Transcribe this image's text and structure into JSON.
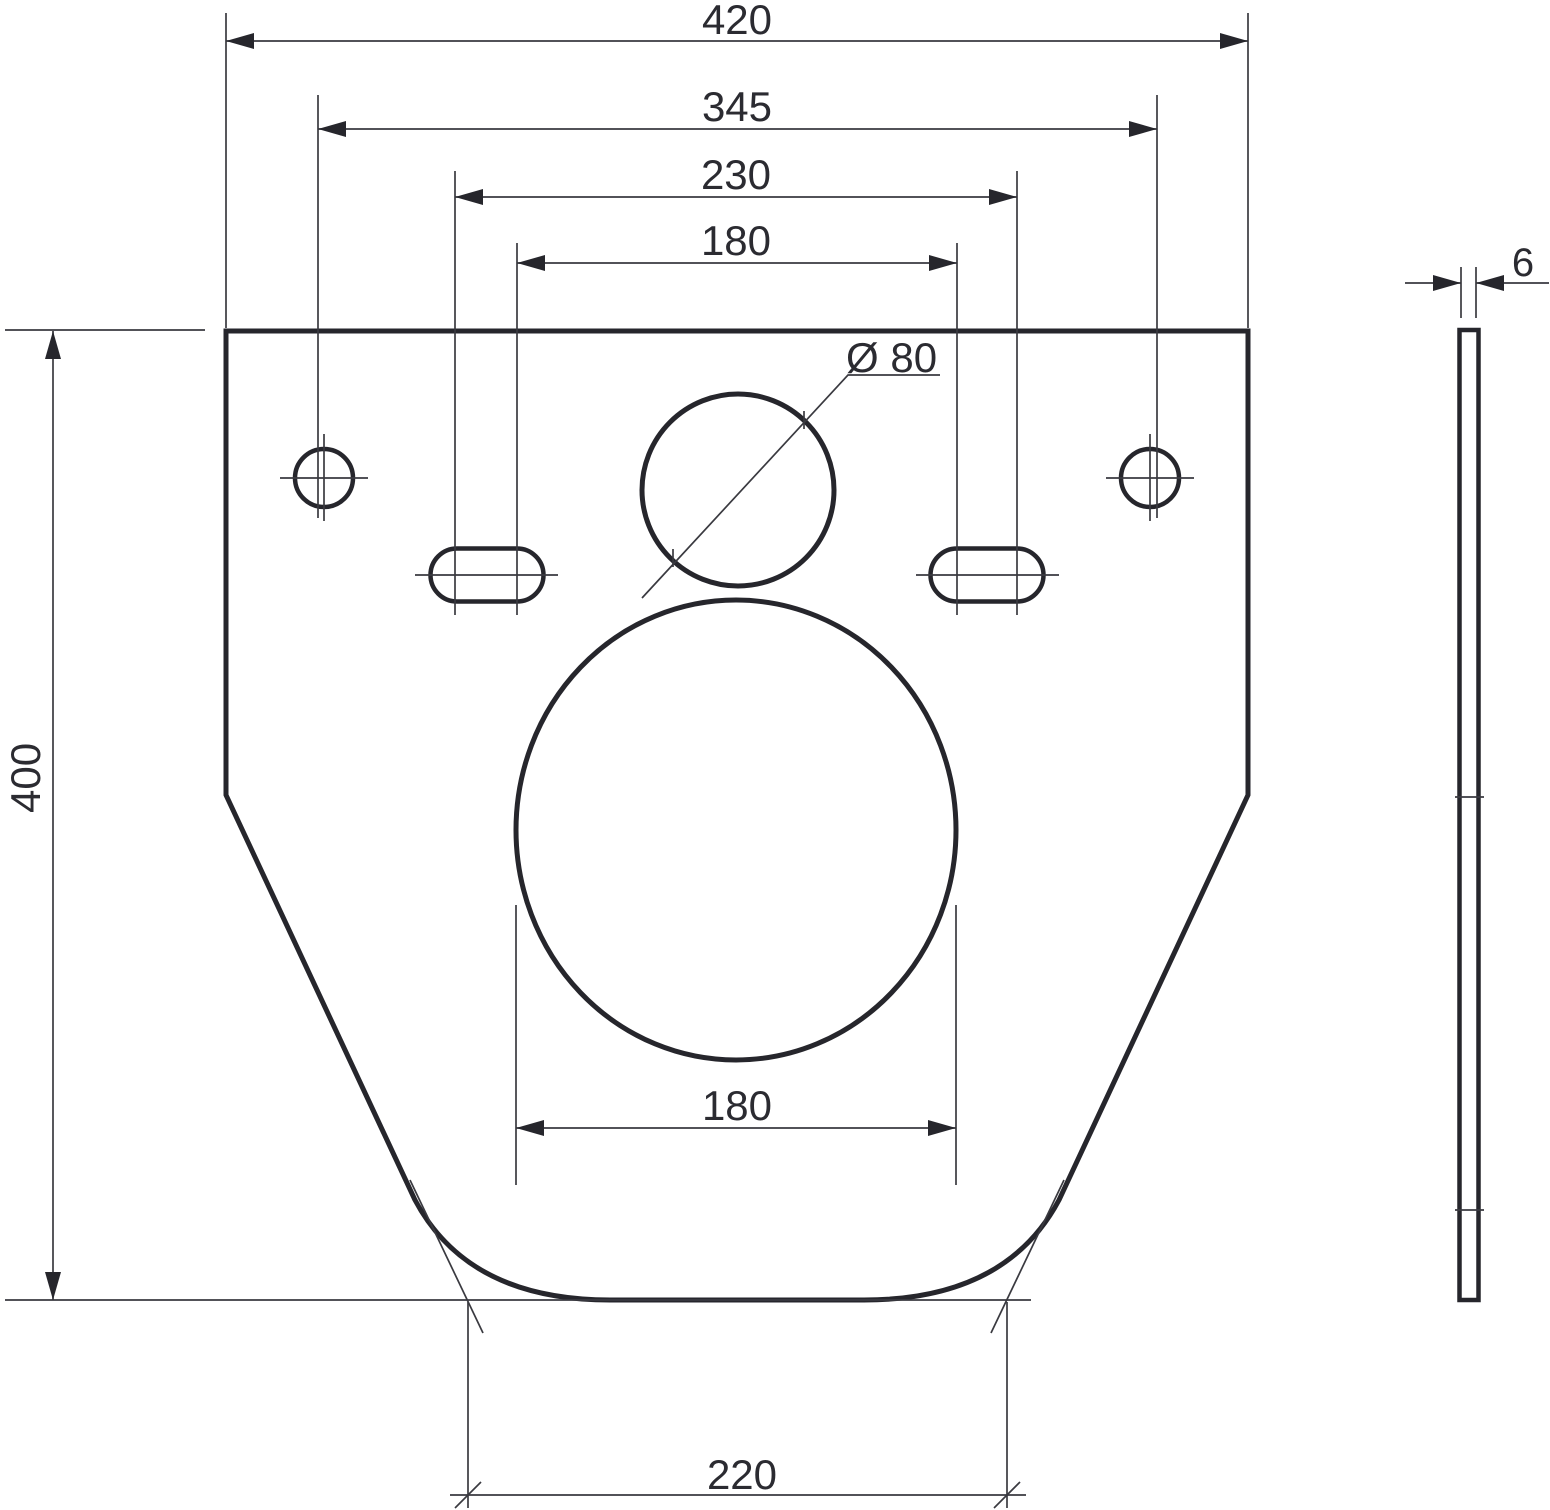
{
  "drawing": {
    "labels": {
      "overall_width": "420",
      "bolt_hole_spacing": "345",
      "slot_spacing_outer": "230",
      "slot_spacing_inner": "180",
      "small_hole_diameter": "Ø 80",
      "large_hole_width": "180",
      "bottom_width": "220",
      "overall_height": "400",
      "plate_thickness": "6"
    },
    "colors": {
      "ink": "#2b2b31",
      "outline": "#26262c",
      "background": "#ffffff"
    }
  }
}
